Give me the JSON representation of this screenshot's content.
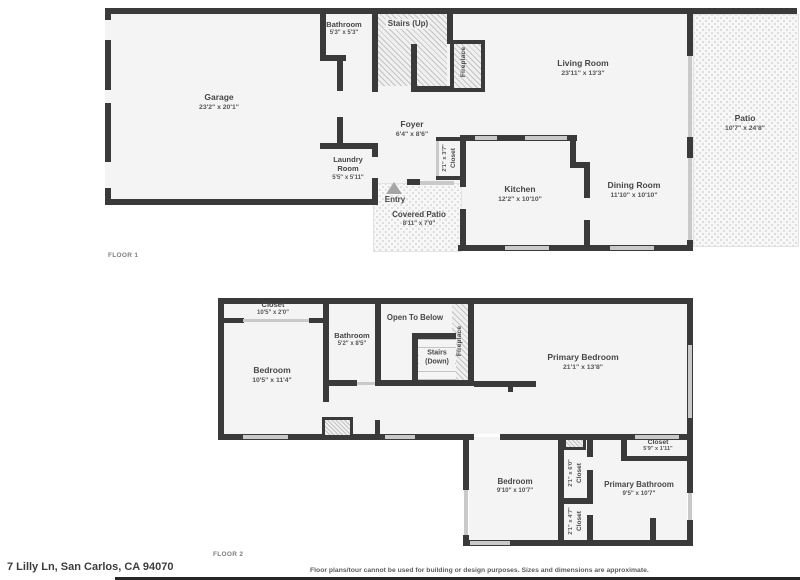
{
  "palette": {
    "wall": "#3a3a3a",
    "room_fill": "#f4f4f4",
    "window": "#c9c9c9",
    "text": "#474747"
  },
  "floor1": {
    "label": "FLOOR 1",
    "rooms": {
      "garage": {
        "name": "Garage",
        "dims": "23'2\" x 20'1\""
      },
      "bathroom": {
        "name": "Bathroom",
        "dims": "5'3\" x 5'3\""
      },
      "stairs": {
        "name": "Stairs (Up)"
      },
      "fireplace": {
        "name": "Fireplace"
      },
      "living": {
        "name": "Living Room",
        "dims": "23'11\" x 13'3\""
      },
      "patio": {
        "name": "Patio",
        "dims": "10'7\" x 24'8\""
      },
      "foyer": {
        "name": "Foyer",
        "dims": "6'4\" x 8'6\""
      },
      "closet": {
        "name": "Closet",
        "dims": "2'1\" x 3'7\""
      },
      "laundry": {
        "name": "Laundry Room",
        "dims": "5'5\" x 5'11\""
      },
      "entry": {
        "name": "Entry"
      },
      "covered_patio": {
        "name": "Covered Patio",
        "dims": "8'11\" x 7'0\""
      },
      "kitchen": {
        "name": "Kitchen",
        "dims": "12'2\" x 10'10\""
      },
      "dining": {
        "name": "Dining Room",
        "dims": "11'10\" x 10'10\""
      }
    }
  },
  "floor2": {
    "label": "FLOOR 2",
    "rooms": {
      "closet_top": {
        "name": "Closet",
        "dims": "10'5\" x 2'0\""
      },
      "bedroom_left": {
        "name": "Bedroom",
        "dims": "10'5\" x 11'4\""
      },
      "bathroom": {
        "name": "Bathroom",
        "dims": "5'2\" x 8'5\""
      },
      "open_below": {
        "name": "Open To Below"
      },
      "stairs": {
        "name": "Stairs (Down)"
      },
      "fireplace": {
        "name": "Fireplace"
      },
      "primary_bedroom": {
        "name": "Primary Bedroom",
        "dims": "21'1\" x 13'8\""
      },
      "closet_right": {
        "name": "Closet",
        "dims": "5'9\" x 1'11\""
      },
      "bedroom_bottom": {
        "name": "Bedroom",
        "dims": "9'10\" x 10'7\""
      },
      "closet_v1": {
        "name": "Closet",
        "dims": "2'1\" x 6'0\""
      },
      "closet_v2": {
        "name": "Closet",
        "dims": "2'1\" x 4'7\""
      },
      "primary_bath": {
        "name": "Primary Bathroom",
        "dims": "9'5\" x 10'7\""
      }
    }
  },
  "footer": {
    "address": "7 Lilly Ln, San Carlos, CA 94070",
    "disclaimer": "Floor plans/tour cannot be used for building or design purposes. Sizes and dimensions are approximate."
  }
}
